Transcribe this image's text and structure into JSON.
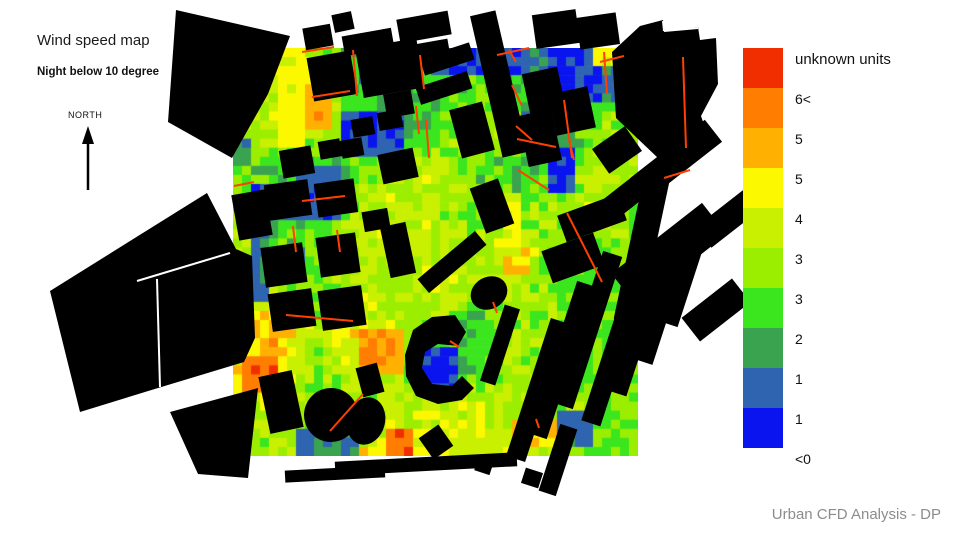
{
  "header": {
    "title": "Wind speed map",
    "subtitle": "Night below 10 degree"
  },
  "compass": {
    "label": "NORTH",
    "x": 88,
    "line_top": 134,
    "line_bottom": 190,
    "head_tip_y": 126,
    "head_base_y": 144,
    "head_half_w": 6
  },
  "footer": {
    "credit": "Urban CFD Analysis - DP"
  },
  "legend": {
    "x": 743,
    "y": 48,
    "swatch_size": 40,
    "label_dx": 52,
    "label_dy": 3,
    "below_label": "<0",
    "entries": [
      {
        "color": "#F02E00",
        "label": "unknown units"
      },
      {
        "color": "#FF7D00",
        "label": "6<"
      },
      {
        "color": "#FFB000",
        "label": "5"
      },
      {
        "color": "#FCF800",
        "label": "5"
      },
      {
        "color": "#C8F000",
        "label": "4"
      },
      {
        "color": "#9CEE00",
        "label": "3"
      },
      {
        "color": "#3CE61E",
        "label": "3"
      },
      {
        "color": "#3AA34F",
        "label": "2"
      },
      {
        "color": "#2E64B0",
        "label": "1"
      },
      {
        "color": "#0A14EE",
        "label": "1"
      }
    ]
  },
  "heatmap": {
    "x": 233,
    "y": 48,
    "w": 405,
    "h": 408,
    "cols": 45,
    "rows": 45,
    "jitter": 0.95,
    "palette": [
      "#0A14EE",
      "#2E64B0",
      "#3AA34F",
      "#3CE61E",
      "#9CEE00",
      "#C8F000",
      "#FCF800",
      "#FFB000",
      "#FF7D00",
      "#F02E00"
    ],
    "control_grid": [
      [
        4,
        6.5,
        5,
        2.5,
        3,
        2,
        3.5,
        2,
        1.5,
        4,
        5.5
      ],
      [
        4,
        6,
        7.5,
        3,
        2.5,
        3.5,
        4,
        3,
        2,
        4,
        5
      ],
      [
        4.5,
        5,
        6,
        2.5,
        1.5,
        4,
        5,
        4,
        2.5,
        4,
        4.5
      ],
      [
        4,
        3,
        2,
        4,
        5,
        5.5,
        4,
        2.5,
        4,
        5,
        4.5
      ],
      [
        4.5,
        2.5,
        3,
        5,
        5.5,
        5,
        4,
        4,
        4.5,
        5.5,
        4
      ],
      [
        5,
        4,
        4,
        5,
        5.5,
        5,
        5,
        6.5,
        4,
        3.5,
        4
      ],
      [
        5,
        5,
        4,
        5,
        5,
        5.5,
        5,
        5,
        4,
        4,
        4
      ],
      [
        6,
        8,
        5,
        7,
        5.5,
        4,
        2.5,
        4.5,
        5,
        4,
        4
      ],
      [
        6.5,
        7.5,
        4,
        6,
        5,
        3.5,
        3.5,
        5,
        5,
        4,
        4
      ],
      [
        5,
        5,
        4,
        3,
        5,
        5.5,
        6,
        5,
        4.5,
        4,
        4
      ],
      [
        4,
        5,
        5,
        6,
        7.5,
        6,
        5.5,
        6,
        5,
        4,
        4
      ]
    ],
    "patches": [
      [
        274,
        48,
        34,
        100,
        6.4
      ],
      [
        306,
        88,
        26,
        46,
        7.6
      ],
      [
        358,
        60,
        36,
        20,
        1.6
      ],
      [
        430,
        50,
        100,
        26,
        1.0
      ],
      [
        550,
        52,
        50,
        48,
        0.8
      ],
      [
        596,
        44,
        42,
        20,
        6.4
      ],
      [
        345,
        108,
        60,
        52,
        1.0
      ],
      [
        300,
        170,
        44,
        48,
        1.4
      ],
      [
        255,
        185,
        42,
        32,
        1.0
      ],
      [
        252,
        232,
        20,
        66,
        1.6
      ],
      [
        290,
        243,
        14,
        20,
        1.2
      ],
      [
        327,
        240,
        16,
        26,
        1.1
      ],
      [
        293,
        298,
        16,
        18,
        1.3
      ],
      [
        522,
        112,
        30,
        36,
        0.8
      ],
      [
        545,
        152,
        34,
        38,
        0.9
      ],
      [
        600,
        70,
        22,
        36,
        1.6
      ],
      [
        424,
        346,
        38,
        42,
        0.8
      ],
      [
        560,
        415,
        30,
        30,
        1.6
      ],
      [
        300,
        428,
        56,
        24,
        1.9
      ],
      [
        238,
        352,
        40,
        36,
        8.8
      ],
      [
        362,
        326,
        42,
        52,
        7.9
      ],
      [
        384,
        428,
        32,
        24,
        8.6
      ],
      [
        504,
        244,
        30,
        28,
        7.4
      ],
      [
        500,
        196,
        22,
        56,
        6.1
      ],
      [
        508,
        424,
        48,
        26,
        6.8
      ],
      [
        233,
        140,
        22,
        30,
        2.2
      ]
    ]
  },
  "hot_lines": {
    "color": "#FF4000",
    "width": 2,
    "segments": [
      [
        302,
        52,
        334,
        47
      ],
      [
        353,
        50,
        357,
        96
      ],
      [
        312,
        97,
        350,
        91
      ],
      [
        420,
        55,
        424,
        89
      ],
      [
        497,
        55,
        529,
        48
      ],
      [
        600,
        62,
        624,
        56
      ],
      [
        604,
        52,
        607,
        94
      ],
      [
        509,
        50,
        516,
        62
      ],
      [
        512,
        85,
        522,
        106
      ],
      [
        516,
        126,
        532,
        140
      ],
      [
        564,
        100,
        572,
        158
      ],
      [
        517,
        139,
        556,
        147
      ],
      [
        569,
        140,
        574,
        160
      ],
      [
        518,
        170,
        549,
        190
      ],
      [
        416,
        106,
        419,
        134
      ],
      [
        426,
        120,
        429,
        158
      ],
      [
        302,
        201,
        345,
        196
      ],
      [
        293,
        226,
        296,
        252
      ],
      [
        337,
        230,
        340,
        252
      ],
      [
        286,
        315,
        353,
        321
      ],
      [
        330,
        431,
        363,
        394
      ],
      [
        450,
        341,
        459,
        347
      ],
      [
        567,
        213,
        602,
        282
      ],
      [
        683,
        57,
        686,
        148
      ],
      [
        664,
        178,
        690,
        170
      ],
      [
        493,
        302,
        497,
        313
      ],
      [
        536,
        419,
        539,
        428
      ],
      [
        234,
        186,
        254,
        182
      ]
    ]
  },
  "buildings": {
    "color": "#000000",
    "polygons": [
      [
        [
          176,
          10
        ],
        [
          290,
          36
        ],
        [
          268,
          94
        ],
        [
          232,
          158
        ],
        [
          168,
          122
        ]
      ],
      [
        [
          207,
          193
        ],
        [
          236,
          249
        ],
        [
          252,
          256
        ],
        [
          255,
          338
        ],
        [
          244,
          362
        ],
        [
          158,
          388
        ],
        [
          80,
          412
        ],
        [
          50,
          291
        ]
      ],
      [
        [
          170,
          412
        ],
        [
          258,
          388
        ],
        [
          248,
          478
        ],
        [
          198,
          474
        ]
      ],
      [
        [
          612,
          52
        ],
        [
          640,
          26
        ],
        [
          663,
          20
        ],
        [
          665,
          31
        ],
        [
          698,
          27
        ],
        [
          700,
          40
        ],
        [
          716,
          38
        ],
        [
          718,
          84
        ],
        [
          701,
          116
        ],
        [
          712,
          148
        ],
        [
          658,
          158
        ],
        [
          616,
          118
        ]
      ],
      [
        [
          405,
          355
        ],
        [
          413,
          330
        ],
        [
          432,
          317
        ],
        [
          455,
          315
        ],
        [
          466,
          332
        ],
        [
          458,
          346
        ],
        [
          438,
          344
        ],
        [
          425,
          352
        ],
        [
          422,
          368
        ],
        [
          432,
          384
        ],
        [
          452,
          386
        ],
        [
          462,
          376
        ],
        [
          474,
          388
        ],
        [
          462,
          400
        ],
        [
          438,
          404
        ],
        [
          416,
          396
        ],
        [
          406,
          376
        ]
      ]
    ],
    "rects": [
      [
        318,
        37,
        28,
        22,
        -10
      ],
      [
        343,
        22,
        20,
        18,
        -12
      ],
      [
        368,
        42,
        50,
        20,
        -10
      ],
      [
        424,
        27,
        52,
        24,
        -10
      ],
      [
        426,
        50,
        46,
        15,
        -10
      ],
      [
        499,
        84,
        26,
        145,
        -13
      ],
      [
        556,
        29,
        44,
        34,
        -8
      ],
      [
        598,
        31,
        40,
        32,
        -8
      ],
      [
        332,
        76,
        44,
        44,
        -10
      ],
      [
        390,
        68,
        62,
        50,
        -10
      ],
      [
        447,
        59,
        52,
        18,
        -18
      ],
      [
        444,
        88,
        54,
        18,
        -18
      ],
      [
        472,
        130,
        34,
        50,
        -15
      ],
      [
        399,
        104,
        28,
        24,
        -10
      ],
      [
        363,
        127,
        22,
        18,
        -10
      ],
      [
        390,
        120,
        24,
        18,
        -10
      ],
      [
        352,
        148,
        22,
        18,
        -10
      ],
      [
        398,
        166,
        36,
        30,
        -12
      ],
      [
        297,
        162,
        32,
        28,
        -10
      ],
      [
        330,
        149,
        22,
        18,
        -10
      ],
      [
        252,
        215,
        34,
        46,
        -10
      ],
      [
        288,
        200,
        44,
        36,
        -8
      ],
      [
        336,
        198,
        40,
        34,
        -8
      ],
      [
        284,
        265,
        42,
        40,
        -8
      ],
      [
        338,
        255,
        40,
        40,
        -8
      ],
      [
        292,
        310,
        44,
        38,
        -8
      ],
      [
        342,
        308,
        44,
        40,
        -8
      ],
      [
        398,
        250,
        26,
        52,
        -12
      ],
      [
        452,
        262,
        75,
        18,
        -40
      ],
      [
        376,
        220,
        26,
        20,
        -10
      ],
      [
        544,
        92,
        36,
        44,
        -12
      ],
      [
        572,
        111,
        40,
        42,
        -12
      ],
      [
        540,
        138,
        34,
        52,
        -12
      ],
      [
        592,
        218,
        64,
        28,
        -20
      ],
      [
        573,
        258,
        55,
        34,
        -20
      ],
      [
        492,
        206,
        30,
        48,
        -20
      ],
      [
        617,
        150,
        40,
        30,
        -35
      ],
      [
        370,
        380,
        22,
        30,
        -15
      ],
      [
        281,
        402,
        34,
        58,
        -12
      ],
      [
        436,
        442,
        24,
        26,
        -35
      ],
      [
        484,
        466,
        16,
        14,
        18
      ],
      [
        532,
        478,
        18,
        16,
        18
      ],
      [
        558,
        460,
        18,
        70,
        18
      ],
      [
        500,
        345,
        16,
        80,
        18
      ],
      [
        538,
        390,
        20,
        145,
        18
      ],
      [
        562,
        360,
        20,
        160,
        18
      ],
      [
        588,
        330,
        20,
        160,
        18
      ],
      [
        614,
        352,
        20,
        150,
        18
      ],
      [
        640,
        322,
        20,
        150,
        18
      ],
      [
        663,
        300,
        20,
        130,
        18
      ],
      [
        686,
        272,
        18,
        110,
        18
      ],
      [
        676,
        160,
        95,
        28,
        -38
      ],
      [
        627,
        196,
        68,
        24,
        -38
      ],
      [
        669,
        254,
        115,
        40,
        -38
      ],
      [
        731,
        216,
        70,
        26,
        -38
      ],
      [
        716,
        310,
        64,
        30,
        -38
      ],
      [
        642,
        248,
        26,
        150,
        12
      ],
      [
        335,
        474,
        100,
        12,
        -3
      ],
      [
        426,
        464,
        182,
        14,
        -3
      ]
    ],
    "ellipses": [
      [
        331,
        415,
        27,
        27,
        -20
      ],
      [
        366,
        421,
        19,
        24,
        15
      ],
      [
        489,
        293,
        19,
        16,
        -30
      ]
    ]
  },
  "white_lines": [
    [
      137,
      281,
      230,
      253
    ],
    [
      157,
      279,
      160,
      387
    ],
    [
      663,
      21,
      664,
      31
    ],
    [
      664,
      31,
      698,
      28
    ]
  ]
}
